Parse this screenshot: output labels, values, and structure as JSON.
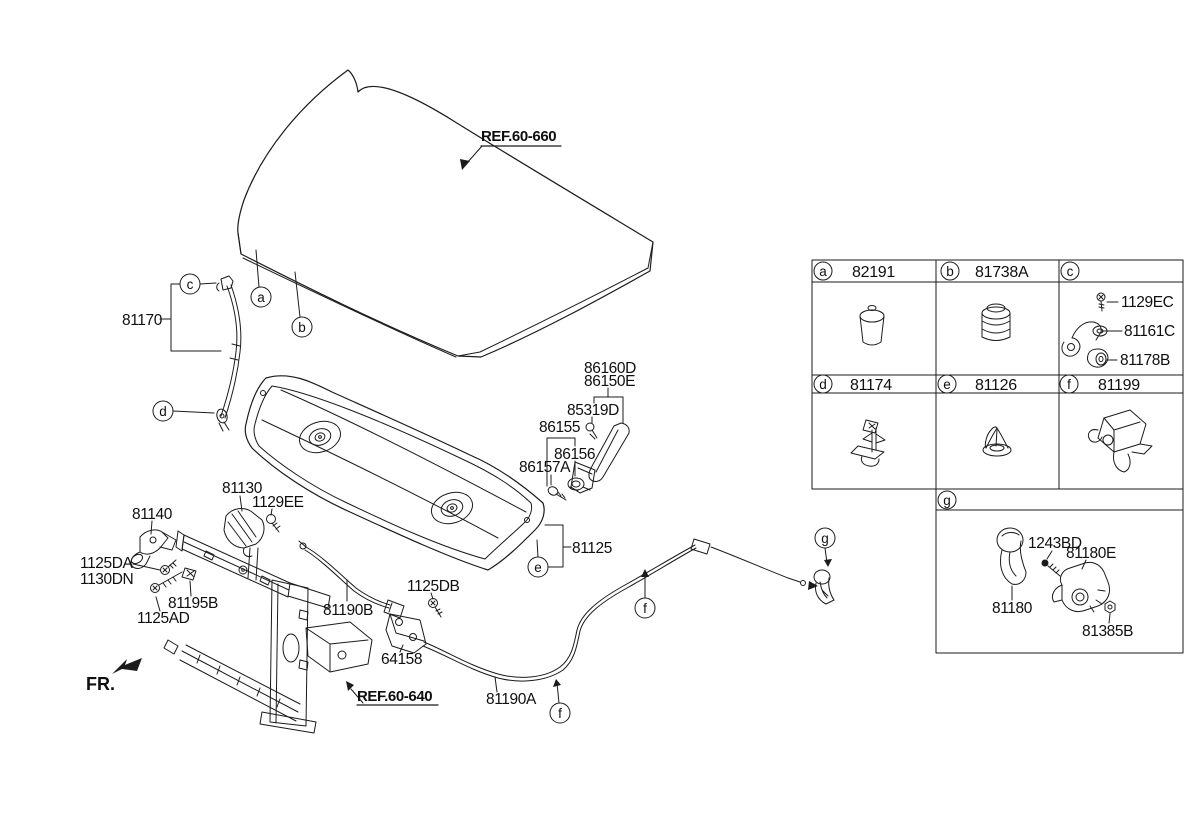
{
  "fr_indicator": "FR.",
  "references": {
    "hood_panel": "REF.60-660",
    "front_end_module": "REF.60-640"
  },
  "callouts": {
    "a": "a",
    "b": "b",
    "c": "c",
    "d": "d",
    "e": "e",
    "f": "f",
    "g": "g"
  },
  "parts": {
    "prop_rod": "81170",
    "hood_latch": "81130",
    "latch_bolt": "1129EE",
    "hood_hinge": "81140",
    "hinge_bolt_upper": "1125DA",
    "hinge_nut": "1130DN",
    "prop_rod_clip": "81195B",
    "hinge_bolt_lower": "1125AD",
    "release_cable_front": "81190B",
    "bracket_bolt": "1125DB",
    "cable_bracket": "64158",
    "release_cable_rear": "81190A",
    "insulator_pad": "81125",
    "weatherstrip_upper": "86160D",
    "weatherstrip_lower": "86150E",
    "weatherstrip_clip": "85319D",
    "side_seal": "86155",
    "side_seal_grommet": "86156",
    "side_seal_screw": "86157A"
  },
  "table": {
    "a": {
      "letter": "a",
      "part": "82191"
    },
    "b": {
      "letter": "b",
      "part": "81738A"
    },
    "c": {
      "letter": "c",
      "bolt": "1129EC",
      "bracket": "81161C",
      "grommet": "81178B"
    },
    "d": {
      "letter": "d",
      "part": "81174"
    },
    "e": {
      "letter": "e",
      "part": "81126"
    },
    "f": {
      "letter": "f",
      "part": "81199"
    },
    "g": {
      "letter": "g",
      "screw": "1243BD",
      "striker": "81180E",
      "handle": "81180",
      "nut": "81385B"
    }
  }
}
